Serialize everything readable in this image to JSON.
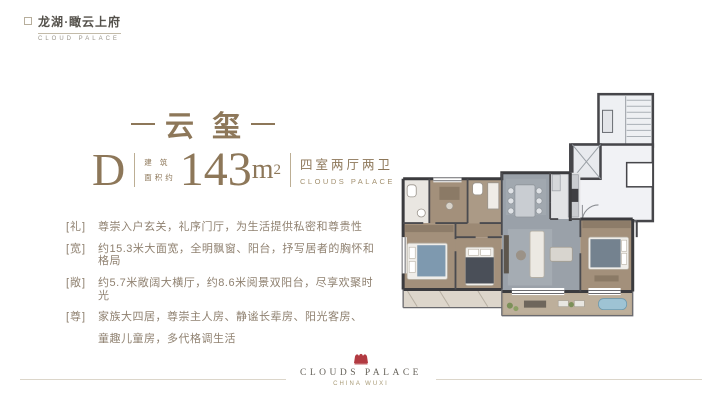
{
  "brand": {
    "name_cn": "龙湖·瞰云上府",
    "name_en": "CLOUD PALACE"
  },
  "hero": {
    "title": "云玺"
  },
  "spec": {
    "type_letter": "D",
    "area_label_line1": "建 筑",
    "area_label_line2": "面积约",
    "area_value": "143",
    "area_unit": "m",
    "area_unit_sup": "2",
    "layout_cn": "四室两厅两卫",
    "layout_en": "CLOUDS PALACE"
  },
  "features": [
    {
      "tag": "[礼]",
      "text": "尊崇入户玄关，礼序门厅，为生活提供私密和尊贵性"
    },
    {
      "tag": "[宽]",
      "text": "约15.3米大面宽，全明飘窗、阳台，抒写居者的胸怀和格局"
    },
    {
      "tag": "[敞]",
      "text": "约5.7米敞阔大横厅，约8.6米阅景双阳台，尽享欢聚时光"
    },
    {
      "tag": "[尊]",
      "text": "家族大四居，尊崇主人房、静谧长辈房、阳光客房、",
      "text_line2": "童趣儿童房，多代格调生活"
    }
  ],
  "footer": {
    "logo_en": "CLOUDS PALACE",
    "logo_sub": "CHINA WUXI"
  },
  "colors": {
    "accent_gold": "#8d7759",
    "body_text": "#8f8170",
    "emblem_red": "#b23a41",
    "wall_dark": "#3b3b3e",
    "wood_floor": "#a3907b",
    "stone_floor": "#9aa1a9"
  }
}
